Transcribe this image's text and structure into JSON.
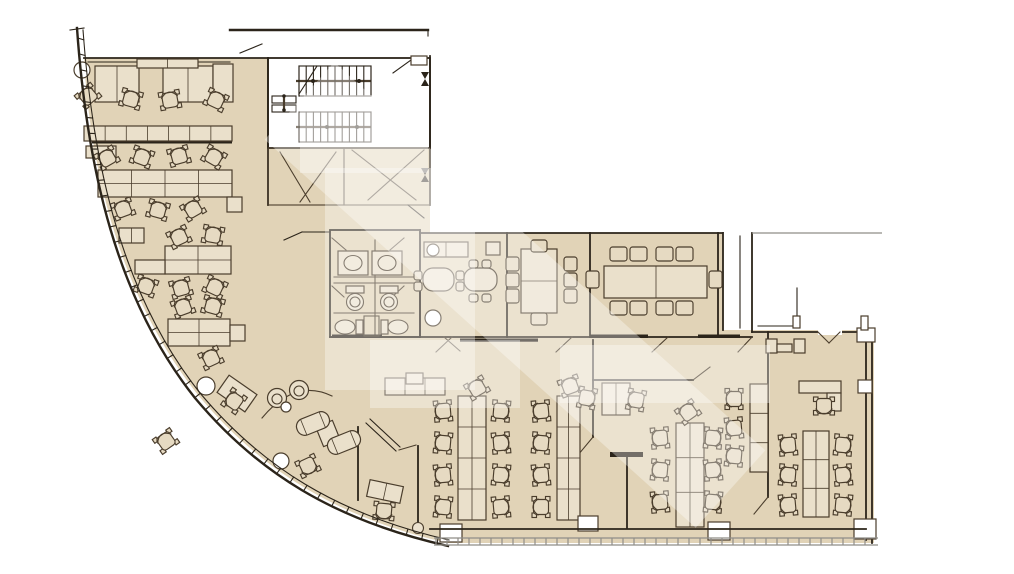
{
  "meta": {
    "type": "floor-plan",
    "label": "office floor plan with curved facade"
  },
  "palette": {
    "bg": "#ffffff",
    "floor": "#e1d3b7",
    "floor_light": "#ece2cf",
    "furniture_fill": "#e6dac2",
    "furniture_fill2": "#eae0cb",
    "line": "#4a3d2c",
    "wall": "#2b241a",
    "glass": "#8f8d88",
    "watermark": "#ffffff",
    "watermark_opacity": 0.34
  },
  "floorplan": {
    "chairs": [
      [
        88,
        96,
        -40
      ],
      [
        131,
        99,
        15
      ],
      [
        170,
        100,
        -10
      ],
      [
        216,
        100,
        25
      ],
      [
        107,
        158,
        -30
      ],
      [
        142,
        157,
        20
      ],
      [
        179,
        156,
        -15
      ],
      [
        214,
        157,
        30
      ],
      [
        123,
        209,
        -20
      ],
      [
        158,
        210,
        15
      ],
      [
        193,
        209,
        -30
      ],
      [
        179,
        237,
        -25
      ],
      [
        213,
        235,
        10
      ],
      [
        146,
        286,
        20
      ],
      [
        181,
        288,
        -15
      ],
      [
        215,
        287,
        25
      ],
      [
        183,
        307,
        -20
      ],
      [
        213,
        306,
        15
      ],
      [
        211,
        358,
        -25
      ],
      [
        234,
        401,
        -55
      ],
      [
        166,
        441,
        -35
      ],
      [
        308,
        466,
        155
      ],
      [
        384,
        511,
        185
      ],
      [
        443,
        411,
        -95
      ],
      [
        443,
        443,
        -85
      ],
      [
        443,
        475,
        -95
      ],
      [
        443,
        507,
        -85
      ],
      [
        501,
        411,
        95
      ],
      [
        501,
        443,
        85
      ],
      [
        501,
        475,
        95
      ],
      [
        501,
        507,
        85
      ],
      [
        477,
        388,
        -30
      ],
      [
        541,
        411,
        -95
      ],
      [
        541,
        443,
        -85
      ],
      [
        541,
        475,
        -95
      ],
      [
        541,
        507,
        -90
      ],
      [
        570,
        386,
        -20
      ],
      [
        587,
        398,
        100
      ],
      [
        636,
        400,
        -80
      ],
      [
        660,
        438,
        -95
      ],
      [
        660,
        470,
        -85
      ],
      [
        660,
        502,
        -95
      ],
      [
        713,
        438,
        95
      ],
      [
        713,
        470,
        85
      ],
      [
        713,
        502,
        95
      ],
      [
        688,
        412,
        -35
      ],
      [
        734,
        399,
        -90
      ],
      [
        734,
        428,
        -95
      ],
      [
        734,
        456,
        -85
      ],
      [
        788,
        445,
        -95
      ],
      [
        788,
        475,
        -85
      ],
      [
        788,
        505,
        -95
      ],
      [
        843,
        445,
        95
      ],
      [
        843,
        475,
        85
      ],
      [
        843,
        505,
        95
      ],
      [
        824,
        406,
        180
      ]
    ],
    "square_chairs": [
      [
        506,
        257,
        13,
        14
      ],
      [
        506,
        273,
        13,
        14
      ],
      [
        506,
        289,
        13,
        14
      ],
      [
        564,
        257,
        13,
        14
      ],
      [
        564,
        273,
        13,
        14
      ],
      [
        564,
        289,
        13,
        14
      ],
      [
        531,
        240,
        16,
        12
      ],
      [
        531,
        313,
        16,
        12
      ],
      [
        610,
        247,
        17,
        14
      ],
      [
        630,
        247,
        17,
        14
      ],
      [
        656,
        247,
        17,
        14
      ],
      [
        676,
        247,
        17,
        14
      ],
      [
        610,
        301,
        17,
        14
      ],
      [
        630,
        301,
        17,
        14
      ],
      [
        656,
        301,
        17,
        14
      ],
      [
        676,
        301,
        17,
        14
      ],
      [
        586,
        271,
        13,
        17
      ],
      [
        709,
        271,
        13,
        17
      ],
      [
        414,
        271,
        8,
        9
      ],
      [
        414,
        282,
        8,
        9
      ],
      [
        456,
        271,
        8,
        9
      ],
      [
        456,
        282,
        8,
        9
      ],
      [
        469,
        260,
        9,
        8
      ],
      [
        482,
        260,
        9,
        8
      ],
      [
        469,
        294,
        9,
        8
      ],
      [
        482,
        294,
        9,
        8
      ]
    ],
    "benches": [
      [
        95,
        66,
        44,
        36,
        2,
        1
      ],
      [
        163,
        66,
        50,
        36,
        2,
        1
      ],
      [
        213,
        64,
        20,
        38,
        1,
        1
      ],
      [
        137,
        59,
        61,
        9,
        2,
        1
      ],
      [
        84,
        126,
        148,
        15,
        7,
        1
      ],
      [
        86,
        146,
        30,
        12,
        1,
        1
      ],
      [
        98,
        170,
        134,
        27,
        4,
        2
      ],
      [
        227,
        197,
        15,
        15,
        1,
        1
      ],
      [
        119,
        228,
        25,
        15,
        2,
        1
      ],
      [
        165,
        246,
        66,
        28,
        2,
        2
      ],
      [
        135,
        260,
        30,
        14,
        1,
        1
      ],
      [
        168,
        319,
        62,
        27,
        2,
        2
      ],
      [
        230,
        325,
        15,
        16,
        1,
        1
      ],
      [
        385,
        378,
        60,
        17,
        3,
        1
      ],
      [
        406,
        373,
        17,
        11,
        1,
        1
      ],
      [
        458,
        396,
        28,
        124,
        2,
        4
      ],
      [
        557,
        396,
        23,
        124,
        2,
        4
      ],
      [
        602,
        383,
        28,
        32,
        2,
        1
      ],
      [
        676,
        423,
        28,
        104,
        2,
        3
      ],
      [
        750,
        384,
        18,
        88,
        1,
        3
      ],
      [
        803,
        431,
        26,
        86,
        2,
        3
      ],
      [
        799,
        381,
        42,
        12,
        1,
        1
      ],
      [
        827,
        393,
        14,
        18,
        1,
        1
      ],
      [
        766,
        339,
        11,
        14,
        1,
        1
      ],
      [
        794,
        339,
        11,
        14,
        1,
        1
      ],
      [
        777,
        344,
        15,
        8,
        1,
        1
      ],
      [
        424,
        242,
        44,
        15,
        2,
        1
      ],
      [
        486,
        242,
        14,
        13,
        1,
        1
      ],
      [
        220,
        383,
        34,
        21,
        1,
        1,
        35
      ],
      [
        319,
        423,
        18,
        21,
        1,
        1,
        -22
      ],
      [
        368,
        483,
        34,
        17,
        2,
        1,
        12
      ]
    ],
    "round_tables": [
      [
        423,
        268,
        31,
        23,
        10
      ],
      [
        464,
        268,
        33,
        23,
        10
      ]
    ],
    "sofas": [
      [
        296,
        415,
        34,
        17,
        -22
      ],
      [
        327,
        434,
        34,
        17,
        -22
      ]
    ],
    "tub_chairs": [
      [
        277,
        398
      ],
      [
        299,
        390
      ]
    ],
    "columns_round": [
      [
        82,
        70,
        8
      ],
      [
        206,
        386,
        9
      ],
      [
        281,
        461,
        8
      ],
      [
        286,
        407,
        5
      ],
      [
        433,
        318,
        8
      ],
      [
        433,
        250,
        6
      ]
    ],
    "columns_square": [
      [
        440,
        524,
        22,
        18
      ],
      [
        578,
        516,
        20,
        15
      ],
      [
        708,
        522,
        22,
        18
      ],
      [
        854,
        519,
        22,
        20
      ],
      [
        857,
        328,
        18,
        14
      ],
      [
        858,
        380,
        14,
        13
      ],
      [
        793,
        316,
        7,
        12
      ],
      [
        861,
        316,
        7,
        14
      ],
      [
        411,
        56,
        16,
        9
      ]
    ]
  }
}
